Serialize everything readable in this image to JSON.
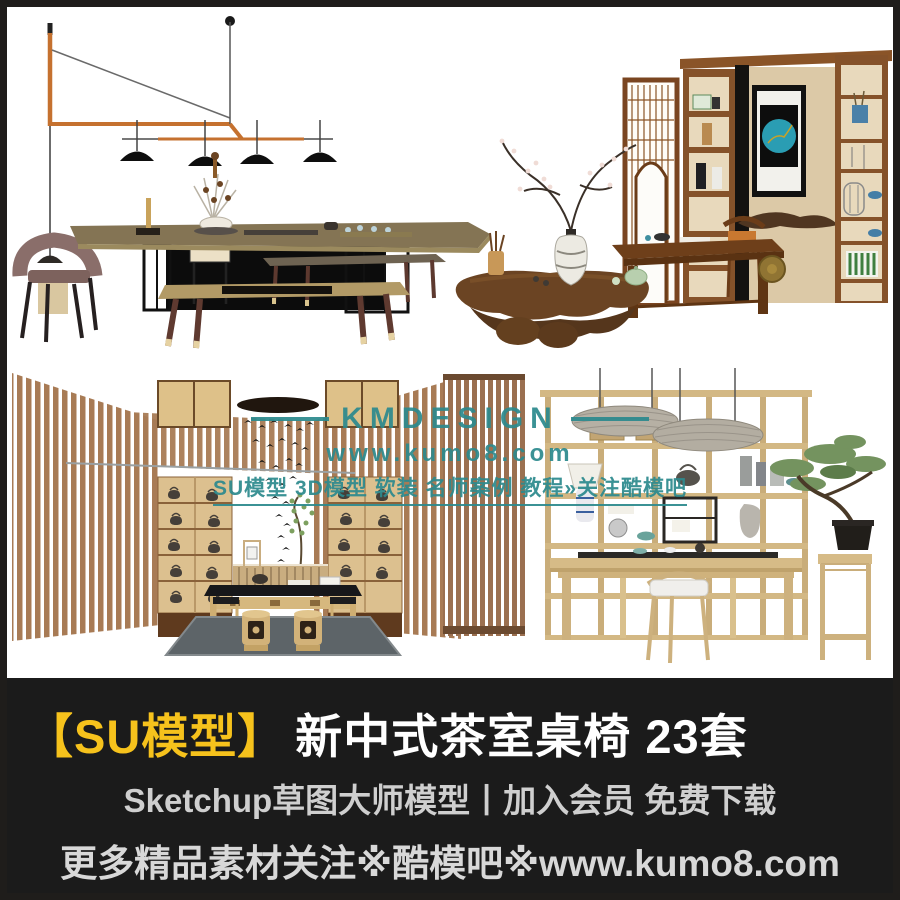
{
  "poster": {
    "kind": "SketchUp model product poster",
    "background": "#ffffff",
    "frame_color": "#1f1d1b"
  },
  "watermark": {
    "brand": "KMDESIGN",
    "url": "www.kumo8.com",
    "tagline": "SU模型 3D模型 软装 名师案例 教程»关注酷模吧",
    "color": "#2d8a8e"
  },
  "banner": {
    "background": "#1b1b1b",
    "title_prefix": "【SU模型】",
    "title_prefix_color": "#f6c21c",
    "title": "新中式茶室桌椅 23套",
    "subtitle": "Sketchup草图大师模型丨加入会员 免费下载",
    "footer": "更多精品素材关注※酷模吧※www.kumo8.com"
  },
  "scenes": [
    {
      "id": "top-left",
      "description": "long tea table with benches, mauve chair, copper linear pendant lamp with four black shades"
    },
    {
      "id": "top-right",
      "description": "wood lattice screen, shelving wall with teal circle artwork, desk and chair, root-carved tea table with plum-blossom vase"
    },
    {
      "id": "bottom-left",
      "description": "tea room with angled wood-slat walls, teapot display shelves, bird mobile, carved stools and gray rug"
    },
    {
      "id": "bottom-right",
      "description": "light-wood display shelf with teaware, two woven pendant lamps, desk with chair, bonsai on tall plant stand"
    }
  ]
}
